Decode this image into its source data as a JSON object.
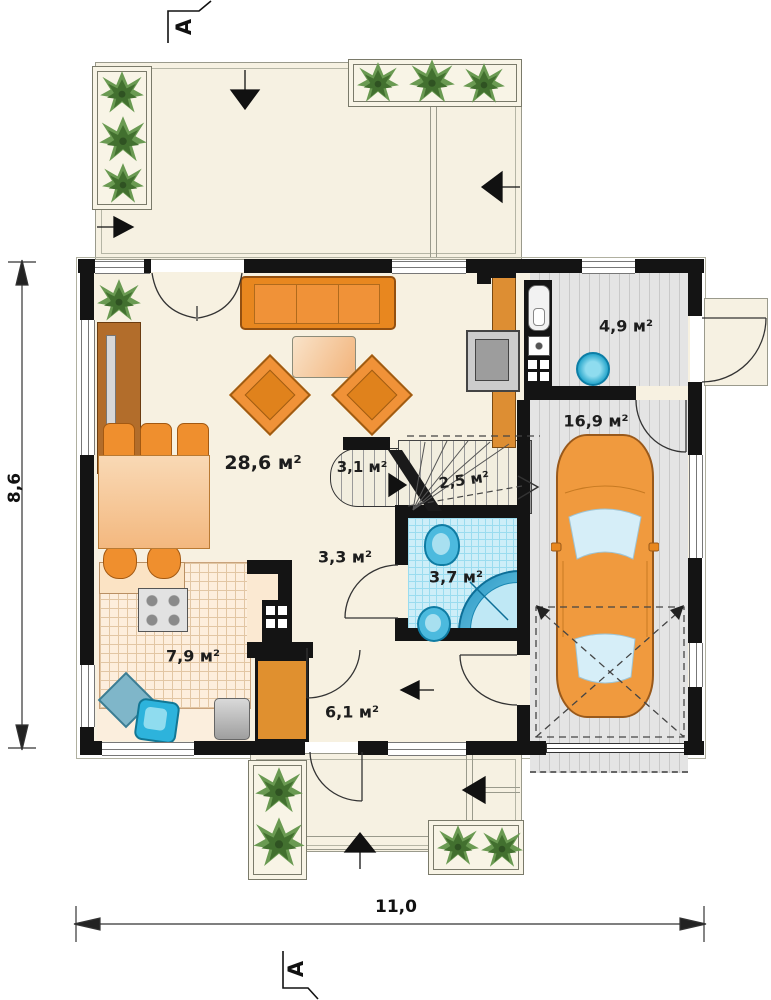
{
  "plan": {
    "section_marker_top": "A",
    "section_marker_bottom": "A",
    "dim_height": "8,6",
    "dim_width": "11,0",
    "rooms": {
      "living": "28,6 м²",
      "pantry": "3,1 м²",
      "stairs": "2,5 м²",
      "hall": "3,3 м²",
      "bath": "3,7 м²",
      "kitchen": "7,9 м²",
      "entry": "6,1 м²",
      "utility": "4,9 м²",
      "garage": "16,9 м²"
    },
    "colors": {
      "wall": "#141414",
      "floor": "#f7f1e1",
      "accent_orange": "#ef9238",
      "bath_blue": "#cdeef8",
      "fixture_blue": "#35b8d6",
      "garage_gray": "#e4e4e4",
      "plant_green": "#5d8a46"
    }
  }
}
